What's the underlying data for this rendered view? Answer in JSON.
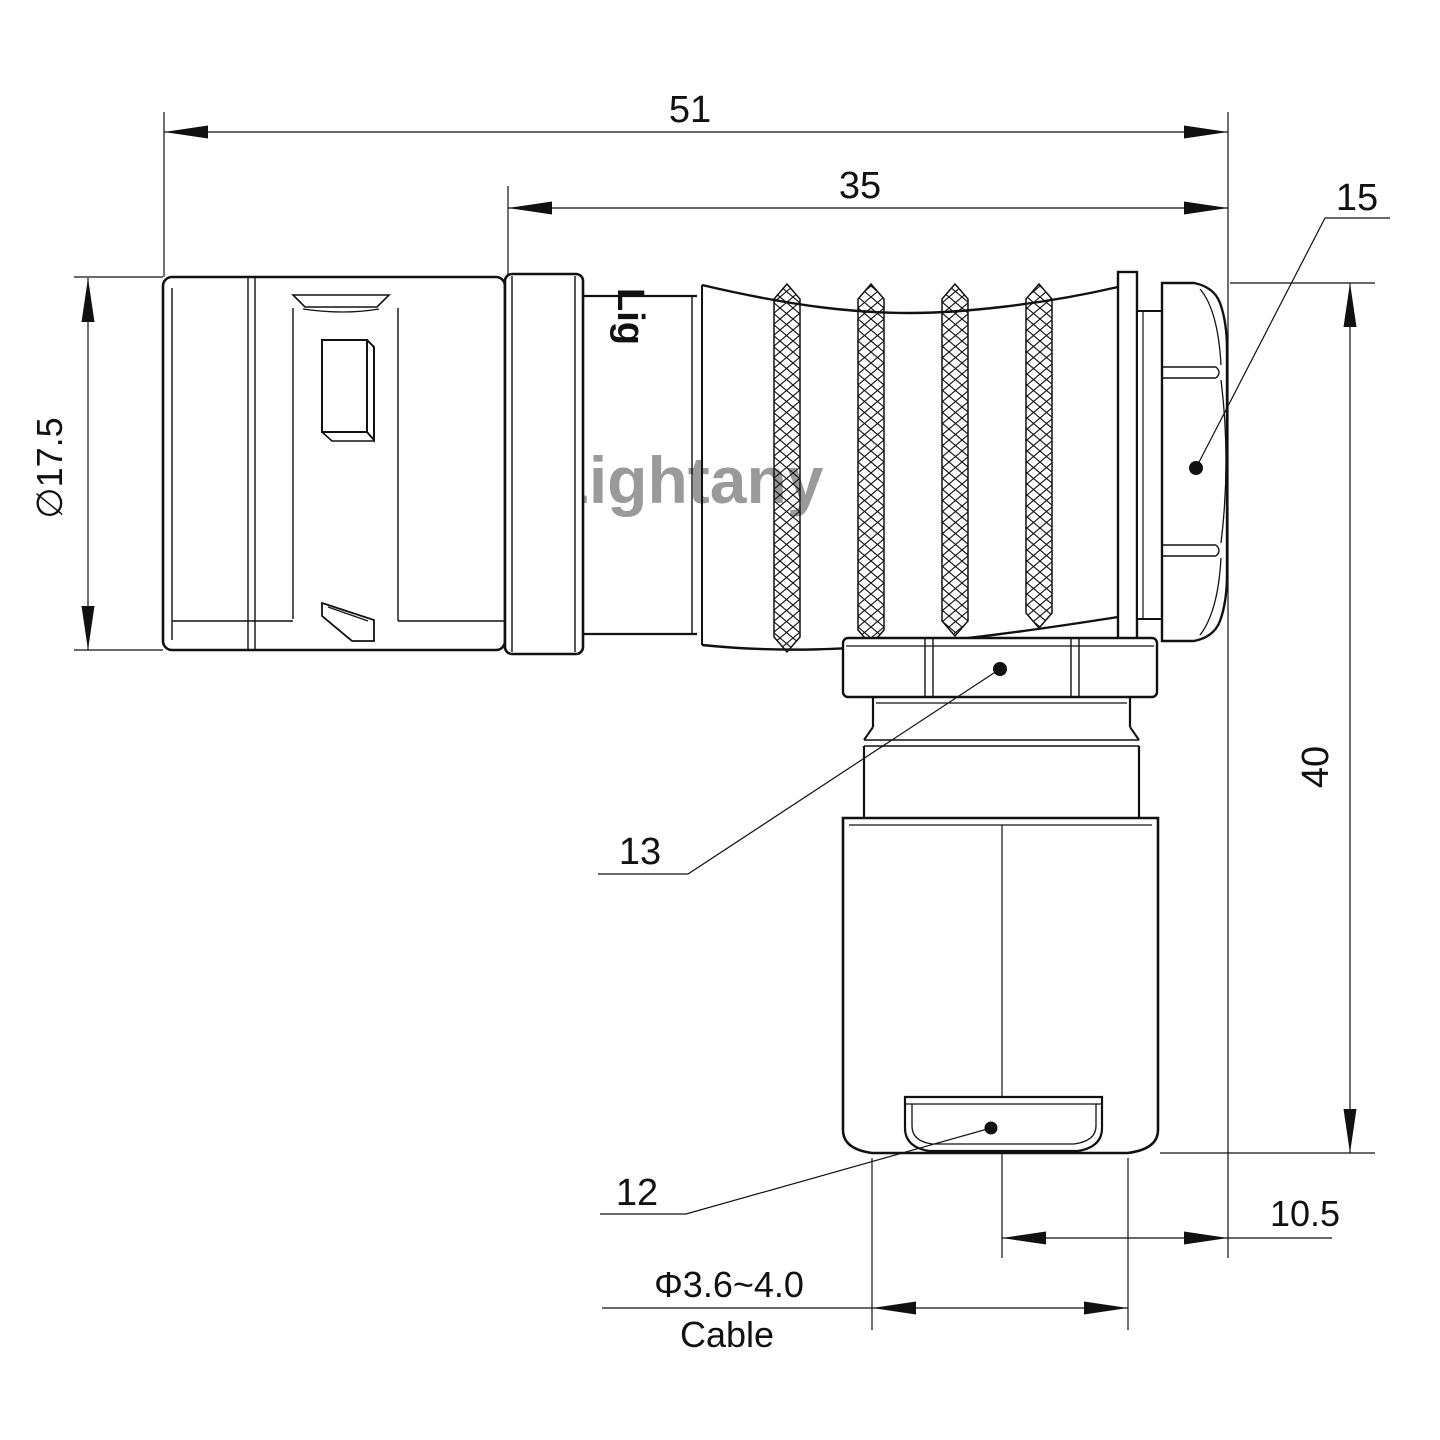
{
  "drawing": {
    "watermark": "Lightany",
    "body_engraving": "Lig",
    "dimensions": {
      "overall_length": "51",
      "grip_length": "35",
      "back_nut_ref": "15",
      "front_diameter": "∅17.5",
      "overall_height": "40",
      "elbow_nut_ref": "13",
      "cable_cap_ref": "12",
      "axis_offset": "10.5",
      "cable_range": "Φ3.6~4.0",
      "cable_word": "Cable"
    },
    "colors": {
      "line": "#111111",
      "watermark": "#e89b9b",
      "background": "#ffffff"
    }
  }
}
